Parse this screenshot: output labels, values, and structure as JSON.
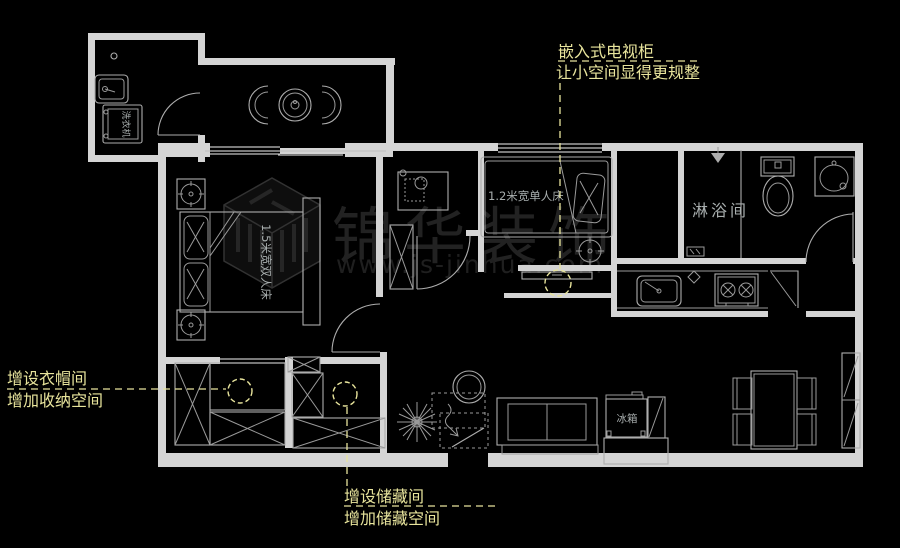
{
  "colors": {
    "background": "#000000",
    "wall_line": "#d4d4d4",
    "furniture_line": "#adadad",
    "annotation_yellow": "#e8e49c",
    "label_gray": "#a8aeae",
    "watermark_gray": "#262626"
  },
  "annotations": {
    "tv": {
      "line1": "嵌入式电视柜",
      "line2": "让小空间显得更规整"
    },
    "wardrobe": {
      "line1": "增设衣帽间",
      "line2": "增加收纳空间"
    },
    "storage": {
      "line1": "增设储藏间",
      "line2": "增加储藏空间"
    }
  },
  "room_labels": {
    "shower": "淋浴间"
  },
  "furniture_labels": {
    "washing_machine": "洗衣机",
    "fridge": "冰箱",
    "double_bed": "1.5米宽双人床",
    "single_bed": "1.2米宽单人床"
  },
  "watermark": {
    "logo_text": "锦华装饰",
    "url": "www.js-jinhua.com"
  }
}
